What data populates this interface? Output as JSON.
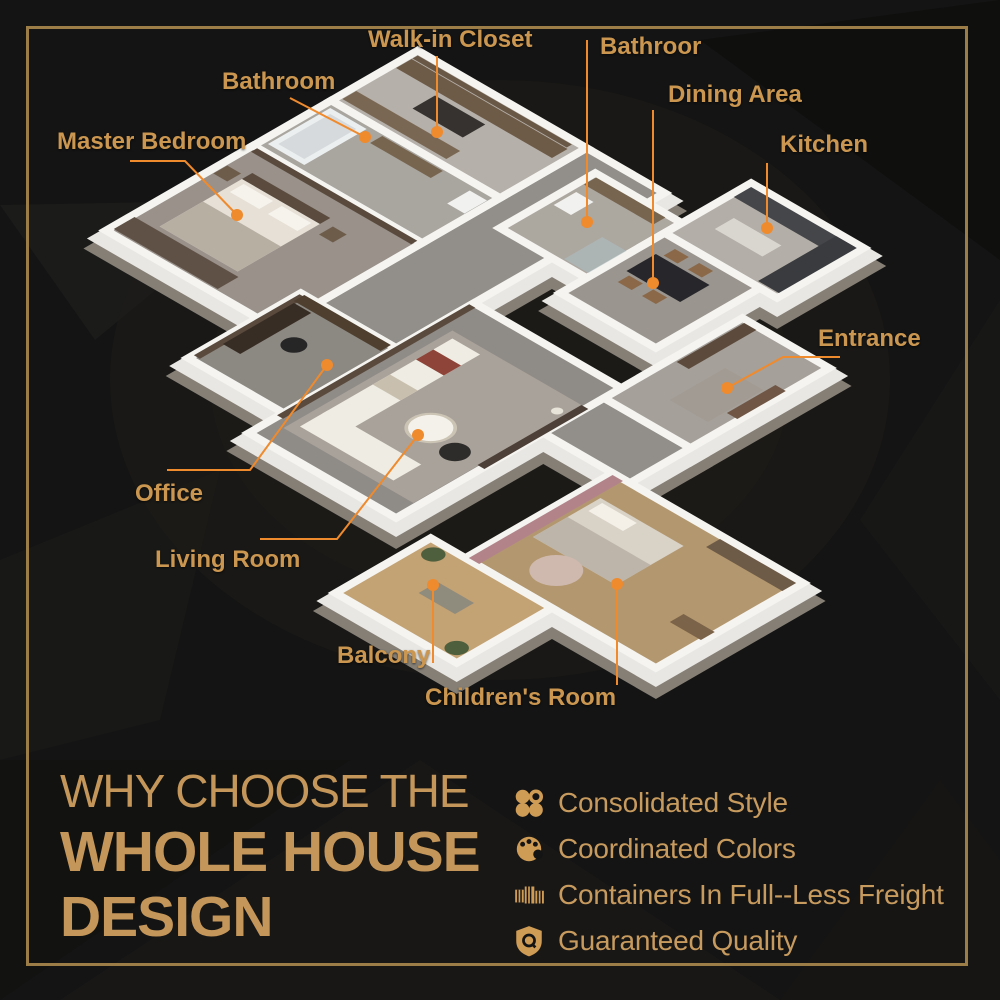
{
  "floorplan": {
    "labels": [
      {
        "id": "master-bedroom",
        "text": "Master Bedroom"
      },
      {
        "id": "bathroom",
        "text": "Bathroom"
      },
      {
        "id": "walk-in-closet",
        "text": "Walk-in Closet"
      },
      {
        "id": "bathroom-2",
        "text": "Bathroor"
      },
      {
        "id": "dining-area",
        "text": "Dining Area"
      },
      {
        "id": "kitchen",
        "text": "Kitchen"
      },
      {
        "id": "entrance",
        "text": "Entrance"
      },
      {
        "id": "office",
        "text": "Office"
      },
      {
        "id": "living-room",
        "text": "Living Room"
      },
      {
        "id": "balcony",
        "text": "Balcony"
      },
      {
        "id": "childrens-room",
        "text": "Children's Room"
      }
    ]
  },
  "heading": {
    "line1": "WHY CHOOSE THE",
    "line2": "WHOLE HOUSE",
    "line3": "DESIGN"
  },
  "features": [
    {
      "icon": "clover-icon",
      "label": "Consolidated Style"
    },
    {
      "icon": "palette-icon",
      "label": "Coordinated Colors"
    },
    {
      "icon": "containers-icon",
      "label": "Containers In Full--Less Freight"
    },
    {
      "icon": "shield-icon",
      "label": "Guaranteed Quality"
    }
  ],
  "colors": {
    "background": "#141414",
    "frame_gold": "#9c7c47",
    "label_gold": "#cb9750",
    "heading_gold": "#c49659",
    "feature_gold": "#c79a5e",
    "leader_orange": "#ef8a2d"
  }
}
